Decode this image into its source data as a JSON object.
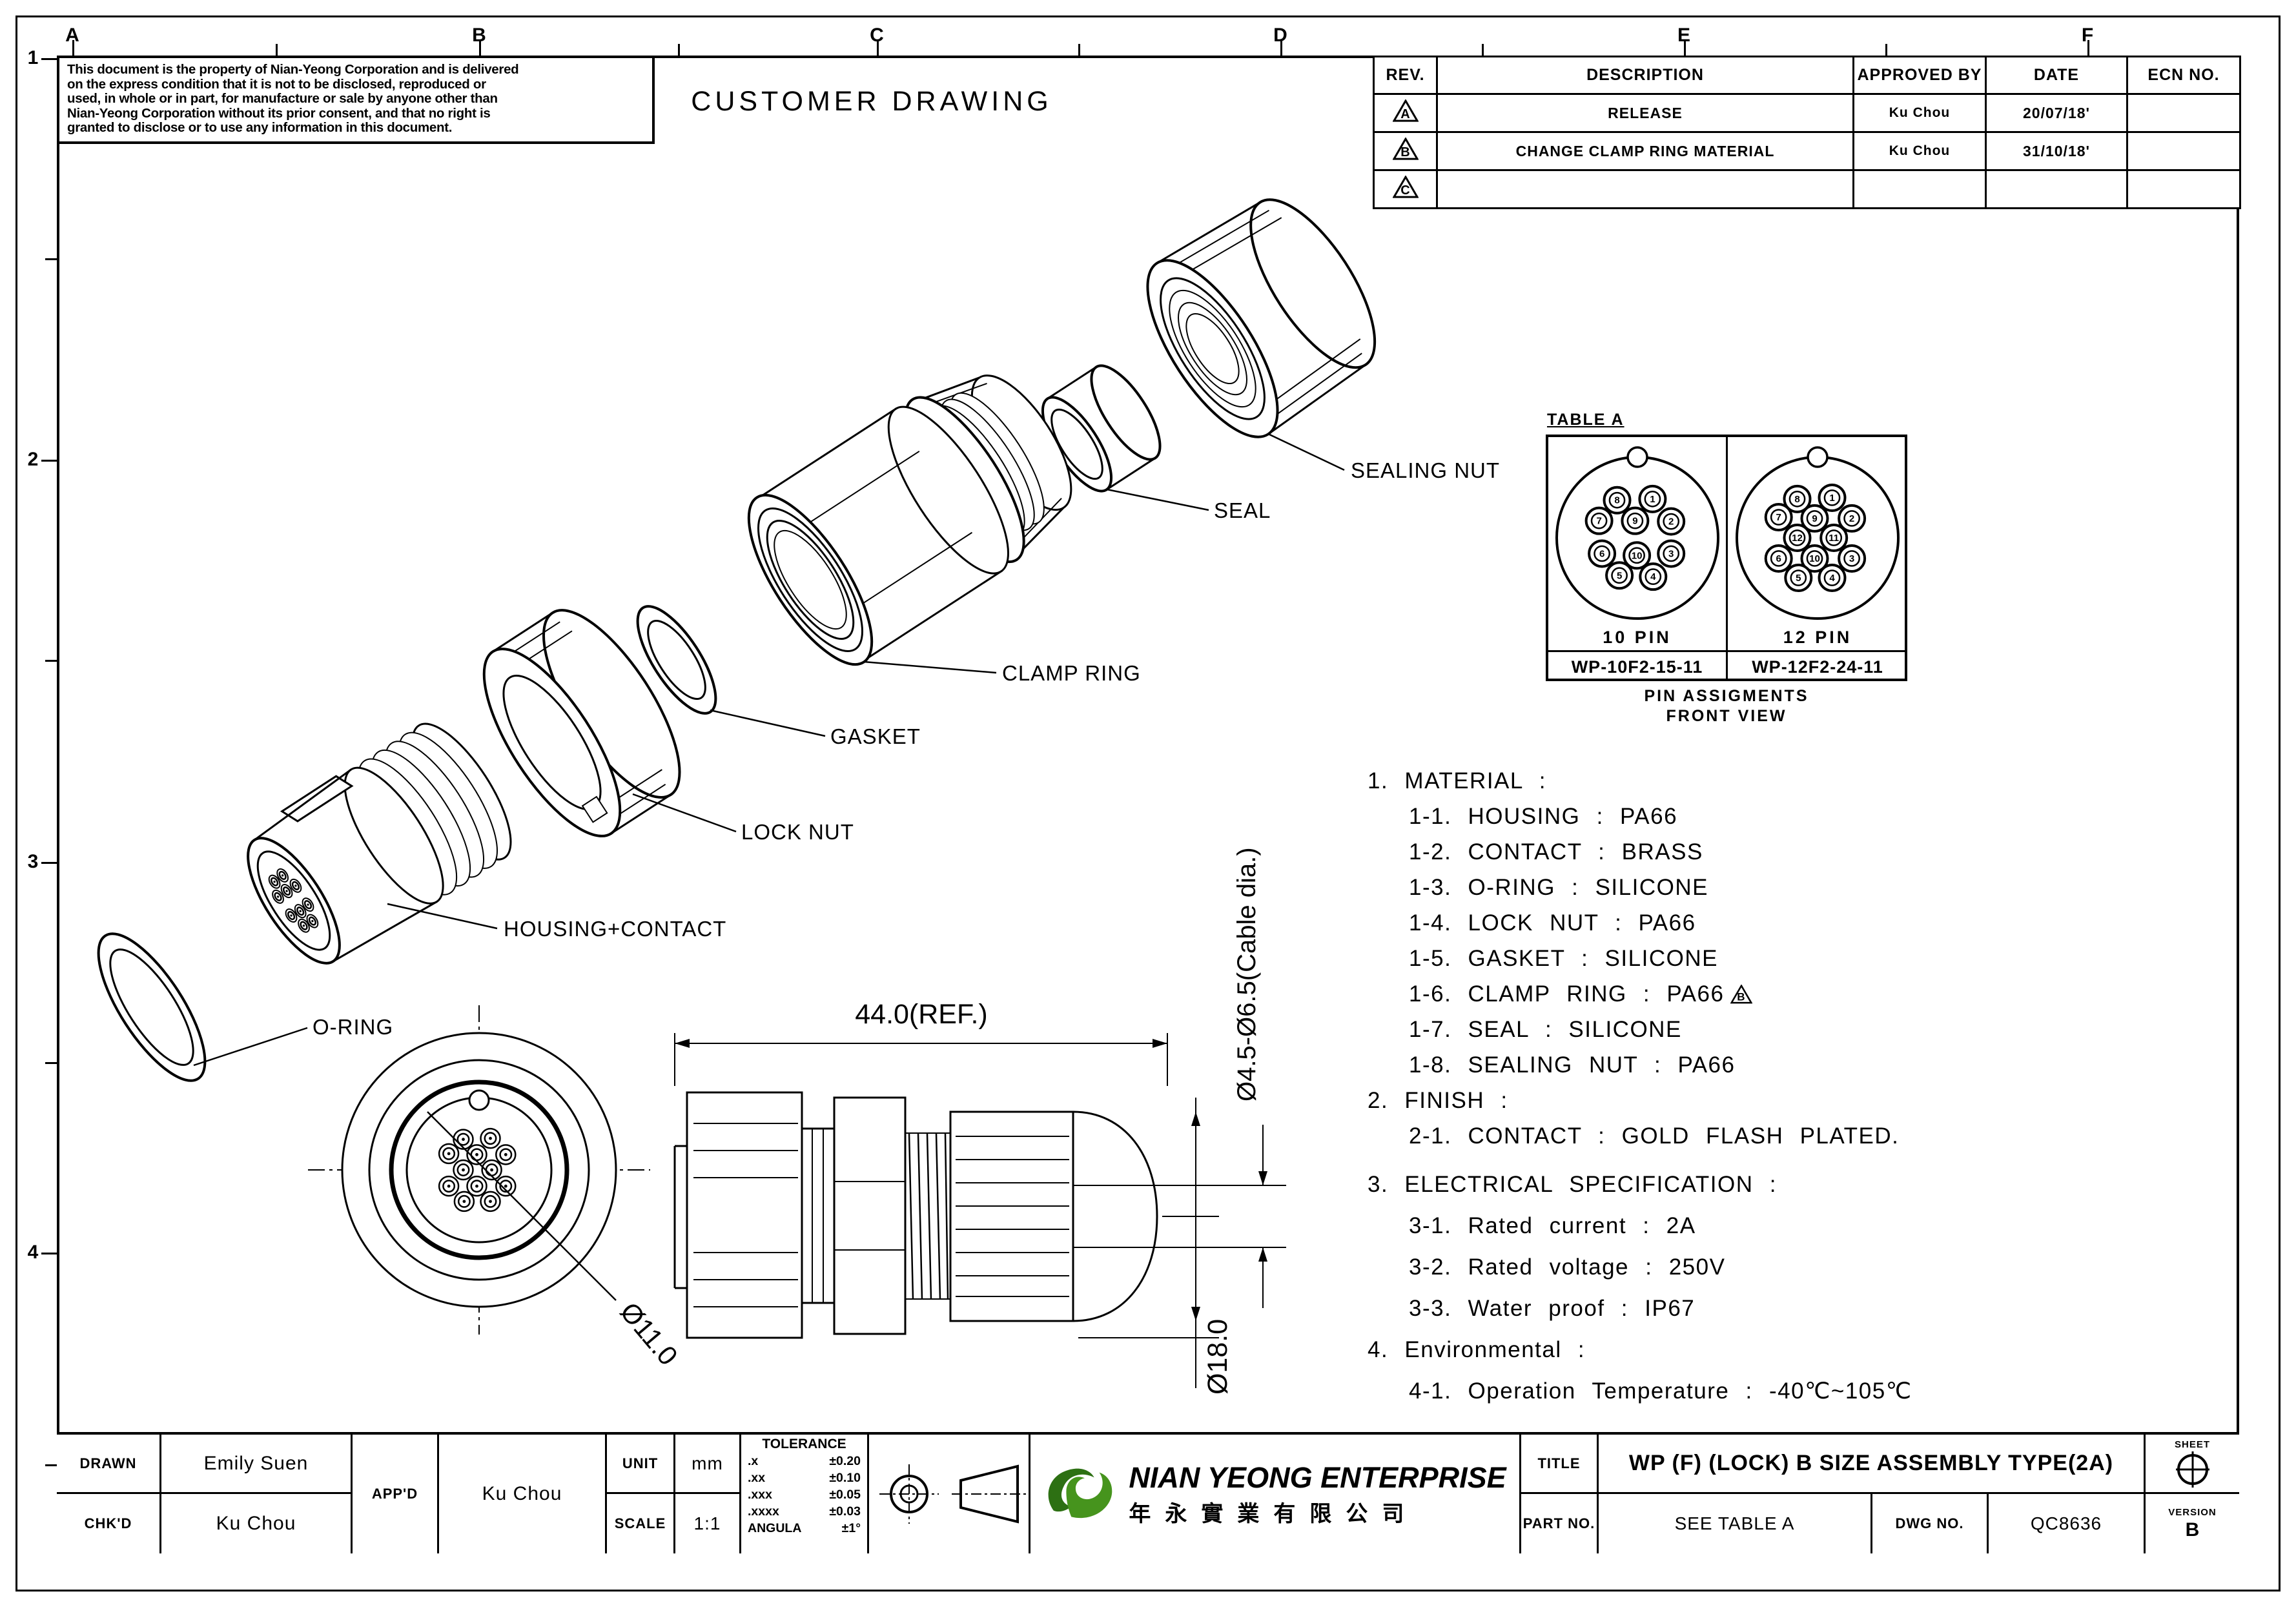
{
  "sheet": {
    "grid_columns": [
      "A",
      "B",
      "C",
      "D",
      "E",
      "F"
    ],
    "grid_rows": [
      "1",
      "2",
      "3",
      "4"
    ]
  },
  "notice": {
    "lines": [
      "This document is the property of Nian-Yeong Corporation and is delivered",
      "on  the  express condition that it is not to be disclosed, reproduced or",
      "used, in whole or in part, for manufacture or sale by anyone other than",
      "Nian-Yeong Corporation without  its prior consent, and that  no right  is",
      "granted to disclose or to use any information in this  document."
    ]
  },
  "heading": "CUSTOMER DRAWING",
  "revision_table": {
    "headers": [
      "REV.",
      "DESCRIPTION",
      "APPROVED BY",
      "DATE",
      "ECN NO."
    ],
    "rows": [
      {
        "rev": "A",
        "description": "RELEASE",
        "approved_by": "Ku Chou",
        "date": "20/07/18'",
        "ecn": ""
      },
      {
        "rev": "B",
        "description": "CHANGE CLAMP RING MATERIAL",
        "approved_by": "Ku Chou",
        "date": "31/10/18'",
        "ecn": ""
      },
      {
        "rev": "C",
        "description": "",
        "approved_by": "",
        "date": "",
        "ecn": ""
      }
    ]
  },
  "exploded": {
    "labels": [
      "SEALING NUT",
      "SEAL",
      "CLAMP RING",
      "GASKET",
      "LOCK NUT",
      "HOUSING+CONTACT",
      "O-RING"
    ]
  },
  "dimensions": {
    "length": "44.0(REF.)",
    "cable": "Ø4.5-Ø6.5(Cable dia.)",
    "front": "Ø11.0",
    "body": "Ø18.0"
  },
  "table_a": {
    "title": "TABLE A",
    "caption1": "PIN ASSIGMENTS",
    "caption2": "FRONT VIEW",
    "variants": [
      {
        "label": "10 PIN",
        "part_no": "WP-10F2-15-11",
        "layout": "pins10"
      },
      {
        "label": "12 PIN",
        "part_no": "WP-12F2-24-11",
        "layout": "pins12"
      }
    ],
    "pins10": [
      {
        "n": "8",
        "x": -0.35,
        "y": -0.62
      },
      {
        "n": "1",
        "x": 0.26,
        "y": -0.64
      },
      {
        "n": "7",
        "x": -0.66,
        "y": -0.28
      },
      {
        "n": "9",
        "x": -0.04,
        "y": -0.28
      },
      {
        "n": "2",
        "x": 0.58,
        "y": -0.27
      },
      {
        "n": "6",
        "x": -0.61,
        "y": 0.26
      },
      {
        "n": "10",
        "x": -0.01,
        "y": 0.29
      },
      {
        "n": "3",
        "x": 0.58,
        "y": 0.26
      },
      {
        "n": "5",
        "x": -0.31,
        "y": 0.62
      },
      {
        "n": "4",
        "x": 0.27,
        "y": 0.64
      }
    ],
    "pins12": [
      {
        "n": "8",
        "x": -0.35,
        "y": -0.64
      },
      {
        "n": "1",
        "x": 0.25,
        "y": -0.66
      },
      {
        "n": "7",
        "x": -0.67,
        "y": -0.34
      },
      {
        "n": "9",
        "x": -0.05,
        "y": -0.32
      },
      {
        "n": "2",
        "x": 0.59,
        "y": -0.32
      },
      {
        "n": "12",
        "x": -0.35,
        "y": 0.0
      },
      {
        "n": "11",
        "x": 0.28,
        "y": 0.0
      },
      {
        "n": "6",
        "x": -0.67,
        "y": 0.34
      },
      {
        "n": "10",
        "x": -0.05,
        "y": 0.34
      },
      {
        "n": "3",
        "x": 0.59,
        "y": 0.34
      },
      {
        "n": "5",
        "x": -0.33,
        "y": 0.66
      },
      {
        "n": "4",
        "x": 0.25,
        "y": 0.66
      }
    ]
  },
  "specs": {
    "lines": [
      {
        "t": "1. MATERIAL :"
      },
      {
        "t": "1-1. HOUSING : PA66",
        "sub": true
      },
      {
        "t": "1-2. CONTACT : BRASS",
        "sub": true
      },
      {
        "t": "1-3. O-RING : SILICONE",
        "sub": true
      },
      {
        "t": "1-4. LOCK NUT : PA66",
        "sub": true
      },
      {
        "t": "1-5. GASKET : SILICONE",
        "sub": true
      },
      {
        "t": "1-6. CLAMP RING : PA66",
        "sub": true,
        "marker": "B"
      },
      {
        "t": "1-7. SEAL : SILICONE",
        "sub": true
      },
      {
        "t": "1-8. SEALING NUT : PA66",
        "sub": true
      },
      {
        "t": "2. FINISH :"
      },
      {
        "t": "2-1. CONTACT : GOLD FLASH PLATED.",
        "sub": true
      },
      {
        "t": "3. ELECTRICAL SPECIFICATION :",
        "mtbig": true
      },
      {
        "t": "3-1. Rated current : 2A",
        "sub": true,
        "mt": true
      },
      {
        "t": "3-2. Rated voltage : 250V",
        "sub": true,
        "mt": true
      },
      {
        "t": "3-3. Water proof : IP67",
        "sub": true,
        "mt": true
      },
      {
        "t": "4. Environmental :",
        "mt": true
      },
      {
        "t": "4-1. Operation Temperature : -40℃~105℃",
        "sub": true,
        "mt": true
      }
    ]
  },
  "title_block": {
    "drawn_label": "DRAWN",
    "drawn_value": "Emily Suen",
    "chkd_label": "CHK'D",
    "chkd_value": "Ku Chou",
    "appd_label": "APP'D",
    "appd_value": "Ku Chou",
    "unit_label": "UNIT",
    "unit_value": "mm",
    "scale_label": "SCALE",
    "scale_value": "1:1",
    "tolerance": {
      "title": "TOLERANCE",
      "rows": [
        [
          ".x",
          "±0.20"
        ],
        [
          ".xx",
          "±0.10"
        ],
        [
          ".xxx",
          "±0.05"
        ],
        [
          ".xxxx",
          "±0.03"
        ],
        [
          "ANGULA",
          "±1°"
        ]
      ]
    },
    "company_en": "NIAN YEONG ENTERPRISE",
    "company_cn": "年永實業有限公司",
    "title_label": "TITLE",
    "title_value": "WP (F) (LOCK) B SIZE ASSEMBLY TYPE(2A)",
    "part_label": "PART NO.",
    "part_value": "SEE TABLE A",
    "dwg_label": "DWG NO.",
    "dwg_value": "QC8636",
    "sheet_label": "SHEET",
    "version_label": "VERSION",
    "version_value": "B",
    "logo_green_dark": "#2d7013",
    "logo_green_light": "#46941d"
  }
}
